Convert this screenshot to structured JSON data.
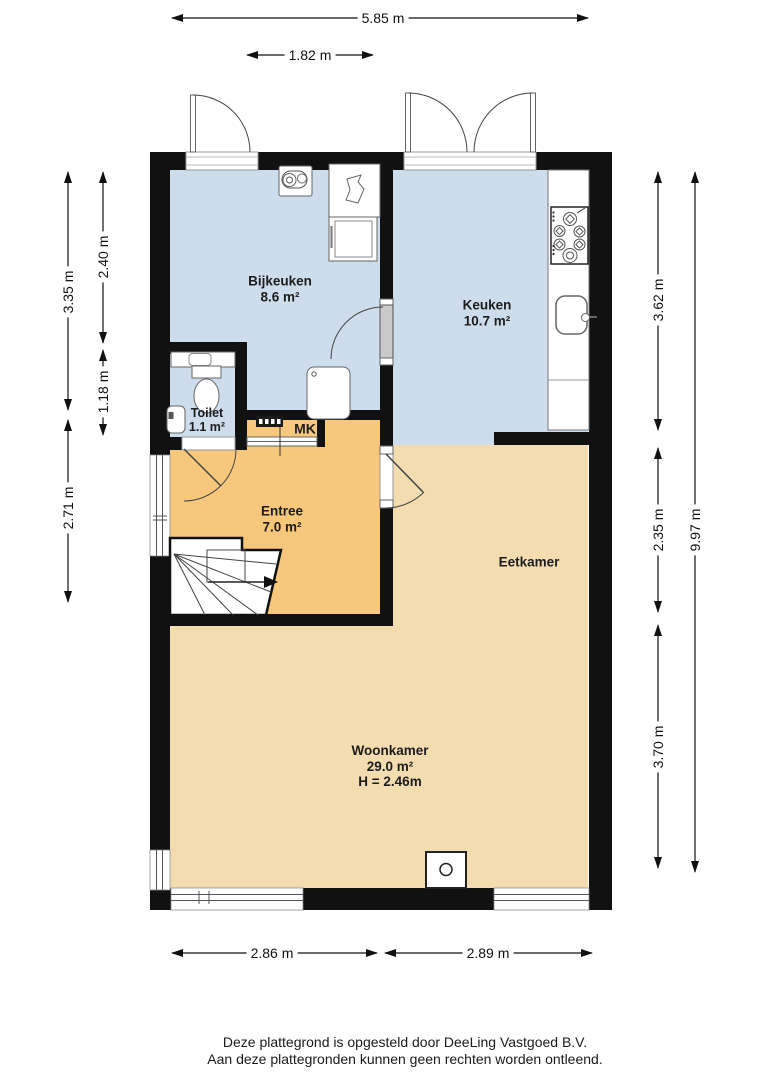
{
  "colors": {
    "wall": "#111111",
    "floor_blue": "#cdddec",
    "floor_tan": "#f2dcb0",
    "floor_orange": "#f7c87c"
  },
  "rooms": {
    "bijkeuken": {
      "name": "Bijkeuken",
      "area": "8.6 m²"
    },
    "keuken": {
      "name": "Keuken",
      "area": "10.7 m²"
    },
    "toilet": {
      "name": "Toilet",
      "area": "1.1 m²"
    },
    "meterkast": {
      "name": "MK"
    },
    "entree": {
      "name": "Entree",
      "area": "7.0 m²"
    },
    "eetkamer": {
      "name": "Eetkamer"
    },
    "woonkamer": {
      "name": "Woonkamer",
      "area": "29.0 m²",
      "ceiling_height": "H = 2.46m"
    }
  },
  "dimensions": {
    "top_total": "5.85 m",
    "top_door": "1.82 m",
    "left_outer_upper": "3.35 m",
    "left_outer_lower": "2.71 m",
    "left_inner_upper": "2.40 m",
    "left_inner_lower": "1.18 m",
    "right_inner_upper": "3.62 m",
    "right_inner_middle": "2.35 m",
    "right_inner_lower": "3.70 m",
    "right_total": "9.97 m",
    "bottom_left": "2.86 m",
    "bottom_right": "2.89 m"
  },
  "footer": {
    "line1": "Deze plattegrond is opgesteld door DeeLing Vastgoed B.V.",
    "line2": "Aan deze plattegronden kunnen geen rechten worden ontleend."
  }
}
